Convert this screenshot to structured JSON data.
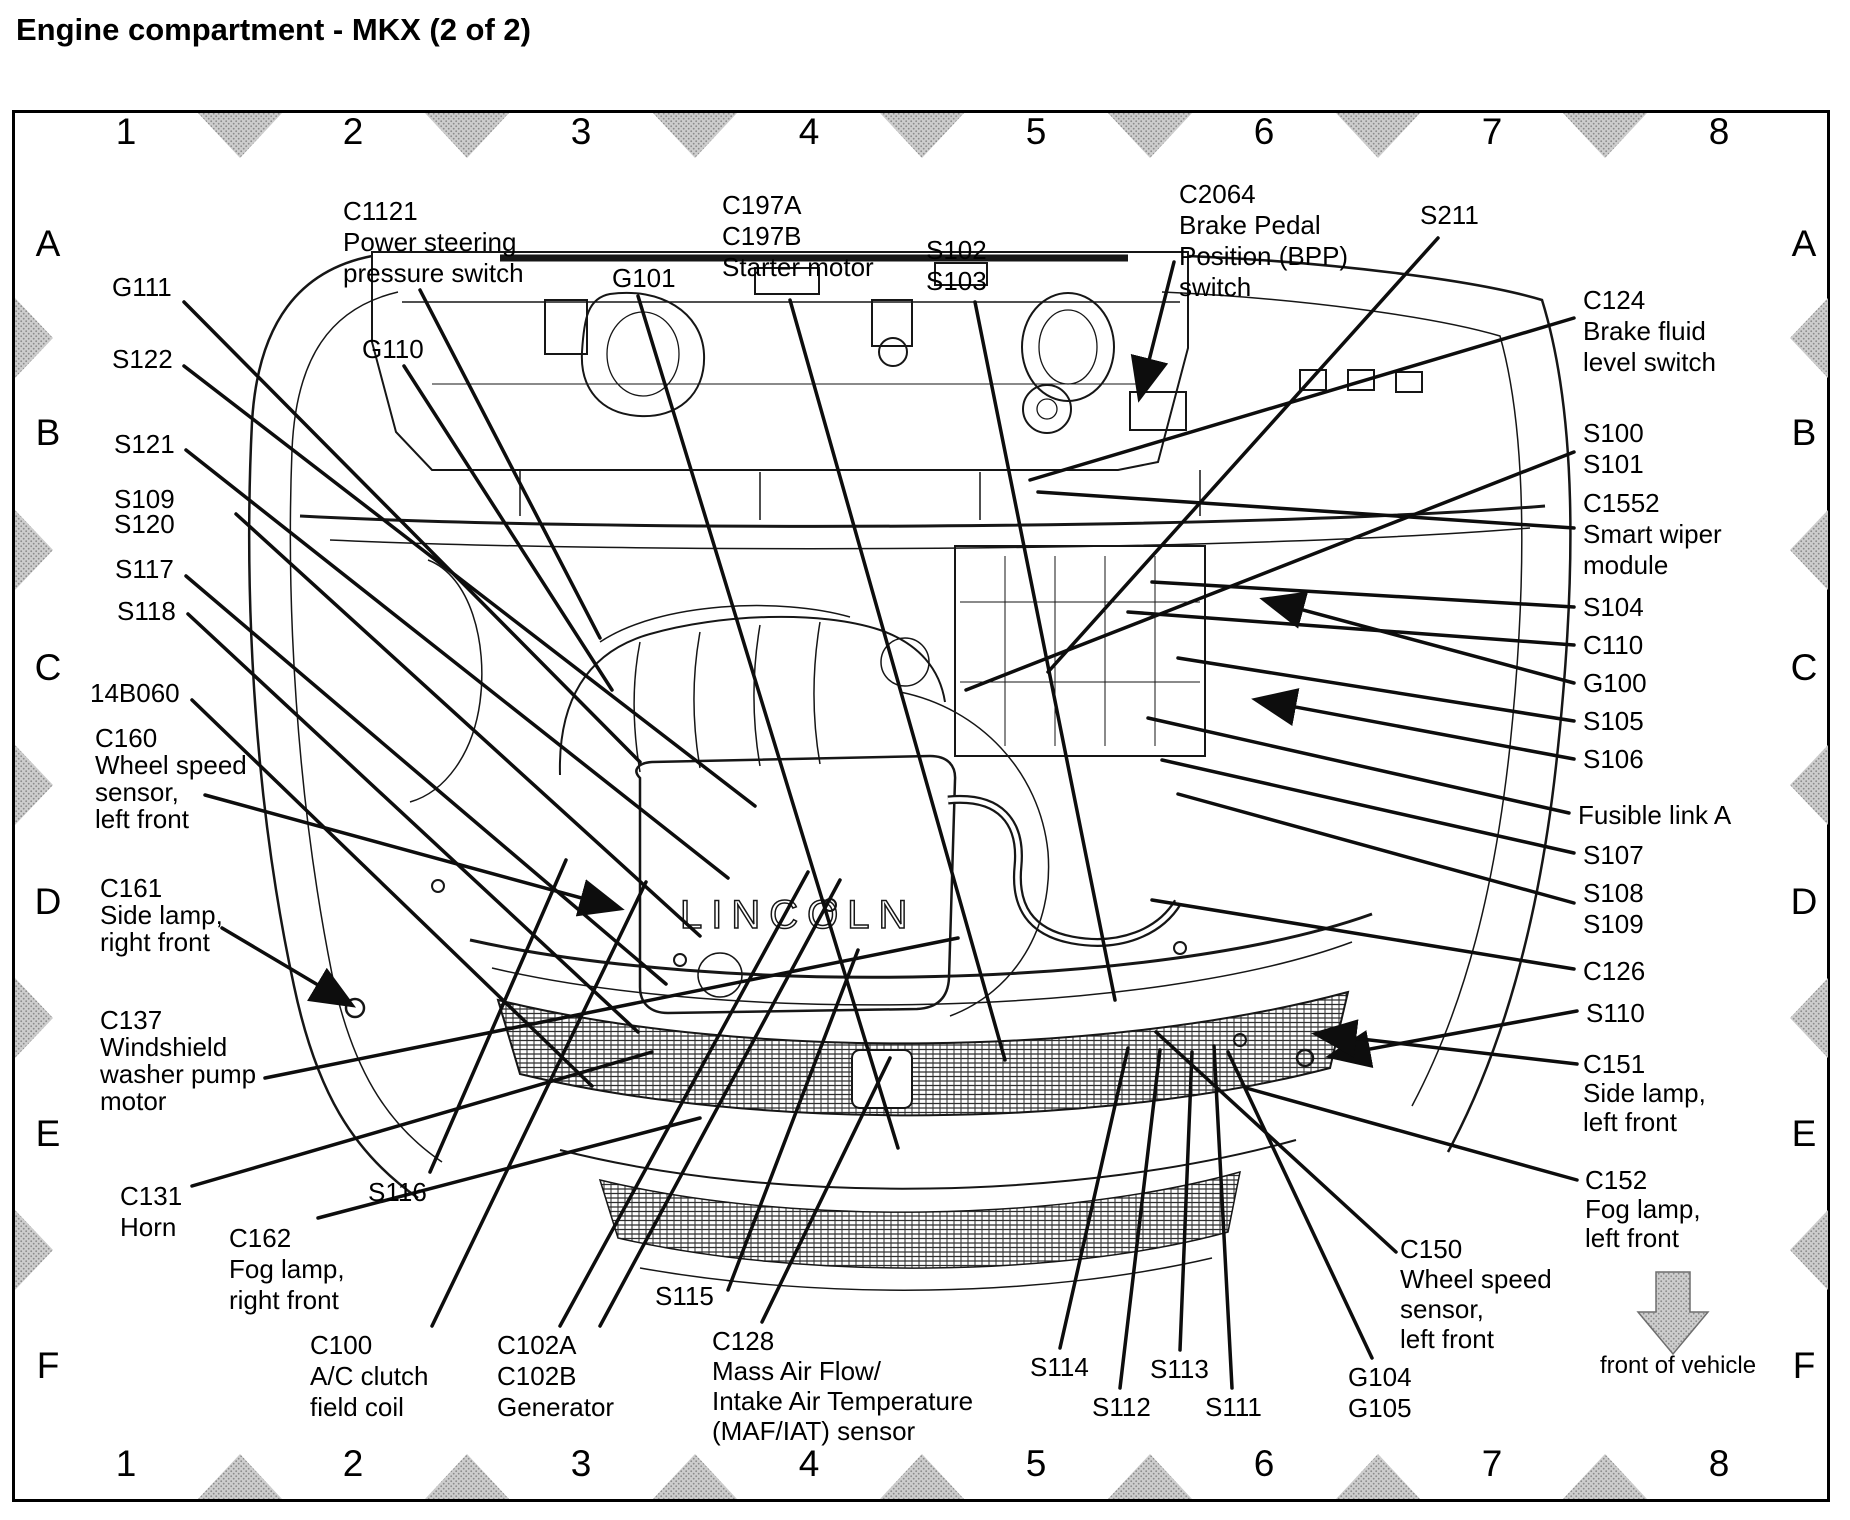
{
  "title": "Engine compartment - MKX (2 of 2)",
  "engine_badge": "LINCOLN",
  "front_arrow_label": "front of vehicle",
  "colors": {
    "line": "#161616",
    "leader": "#0d0d0d",
    "marker_gray": "#c9c9c9",
    "paper": "#ffffff"
  },
  "grid": {
    "columns": [
      "1",
      "2",
      "3",
      "4",
      "5",
      "6",
      "7",
      "8"
    ],
    "rows": [
      "A",
      "B",
      "C",
      "D",
      "E",
      "F"
    ]
  },
  "callouts": {
    "c1121": {
      "lines": [
        "C1121",
        "Power steering",
        "pressure switch"
      ]
    },
    "g111": {
      "lines": [
        "G111"
      ]
    },
    "g110": {
      "lines": [
        "G110"
      ]
    },
    "s122": {
      "lines": [
        "S122"
      ]
    },
    "s121": {
      "lines": [
        "S121"
      ]
    },
    "s109_s120": {
      "lines": [
        "S109",
        "S120"
      ]
    },
    "s117": {
      "lines": [
        "S117"
      ]
    },
    "s118": {
      "lines": [
        "S118"
      ]
    },
    "id14b060": {
      "lines": [
        "14B060"
      ]
    },
    "c160": {
      "lines": [
        "C160",
        "Wheel speed",
        "sensor,",
        "left front"
      ]
    },
    "c161": {
      "lines": [
        "C161",
        "Side lamp,",
        "right front"
      ]
    },
    "c137": {
      "lines": [
        "C137",
        "Windshield",
        "washer pump",
        "motor"
      ]
    },
    "c131": {
      "lines": [
        "C131",
        "Horn"
      ]
    },
    "c162": {
      "lines": [
        "C162",
        "Fog lamp,",
        "right front"
      ]
    },
    "s116": {
      "lines": [
        "S116"
      ]
    },
    "c100": {
      "lines": [
        "C100",
        "A/C clutch",
        "field coil"
      ]
    },
    "c102": {
      "lines": [
        "C102A",
        "C102B",
        "Generator"
      ]
    },
    "g101": {
      "lines": [
        "G101"
      ]
    },
    "c197": {
      "lines": [
        "C197A",
        "C197B",
        "Starter motor"
      ]
    },
    "s102_s103": {
      "lines": [
        "S102",
        "S103"
      ]
    },
    "c2064": {
      "lines": [
        "C2064",
        "Brake Pedal",
        "Position (BPP)",
        "switch"
      ]
    },
    "s211": {
      "lines": [
        "S211"
      ]
    },
    "c124": {
      "lines": [
        "C124",
        "Brake fluid",
        "level switch"
      ]
    },
    "s100_s101": {
      "lines": [
        "S100",
        "S101"
      ]
    },
    "c1552": {
      "lines": [
        "C1552",
        "Smart wiper",
        "module"
      ]
    },
    "s104": {
      "lines": [
        "S104"
      ]
    },
    "c110": {
      "lines": [
        "C110"
      ]
    },
    "g100": {
      "lines": [
        "G100"
      ]
    },
    "s105": {
      "lines": [
        "S105"
      ]
    },
    "s106": {
      "lines": [
        "S106"
      ]
    },
    "fusible_link_a": {
      "lines": [
        "Fusible link A"
      ]
    },
    "s107": {
      "lines": [
        "S107"
      ]
    },
    "s108_s109": {
      "lines": [
        "S108",
        "S109"
      ]
    },
    "c126": {
      "lines": [
        "C126"
      ]
    },
    "s110": {
      "lines": [
        "S110"
      ]
    },
    "c151": {
      "lines": [
        "C151",
        "Side lamp,",
        "left front"
      ]
    },
    "c152": {
      "lines": [
        "C152",
        "Fog lamp,",
        "left front"
      ]
    },
    "c150": {
      "lines": [
        "C150",
        "Wheel speed",
        "sensor,",
        "left front"
      ]
    },
    "g104_g105": {
      "lines": [
        "G104",
        "G105"
      ]
    },
    "s111": {
      "lines": [
        "S111"
      ]
    },
    "s112": {
      "lines": [
        "S112"
      ]
    },
    "s113": {
      "lines": [
        "S113"
      ]
    },
    "s114": {
      "lines": [
        "S114"
      ]
    },
    "s115": {
      "lines": [
        "S115"
      ]
    },
    "c128": {
      "lines": [
        "C128",
        "Mass Air Flow/",
        "Intake Air Temperature",
        "(MAF/IAT) sensor"
      ]
    }
  }
}
